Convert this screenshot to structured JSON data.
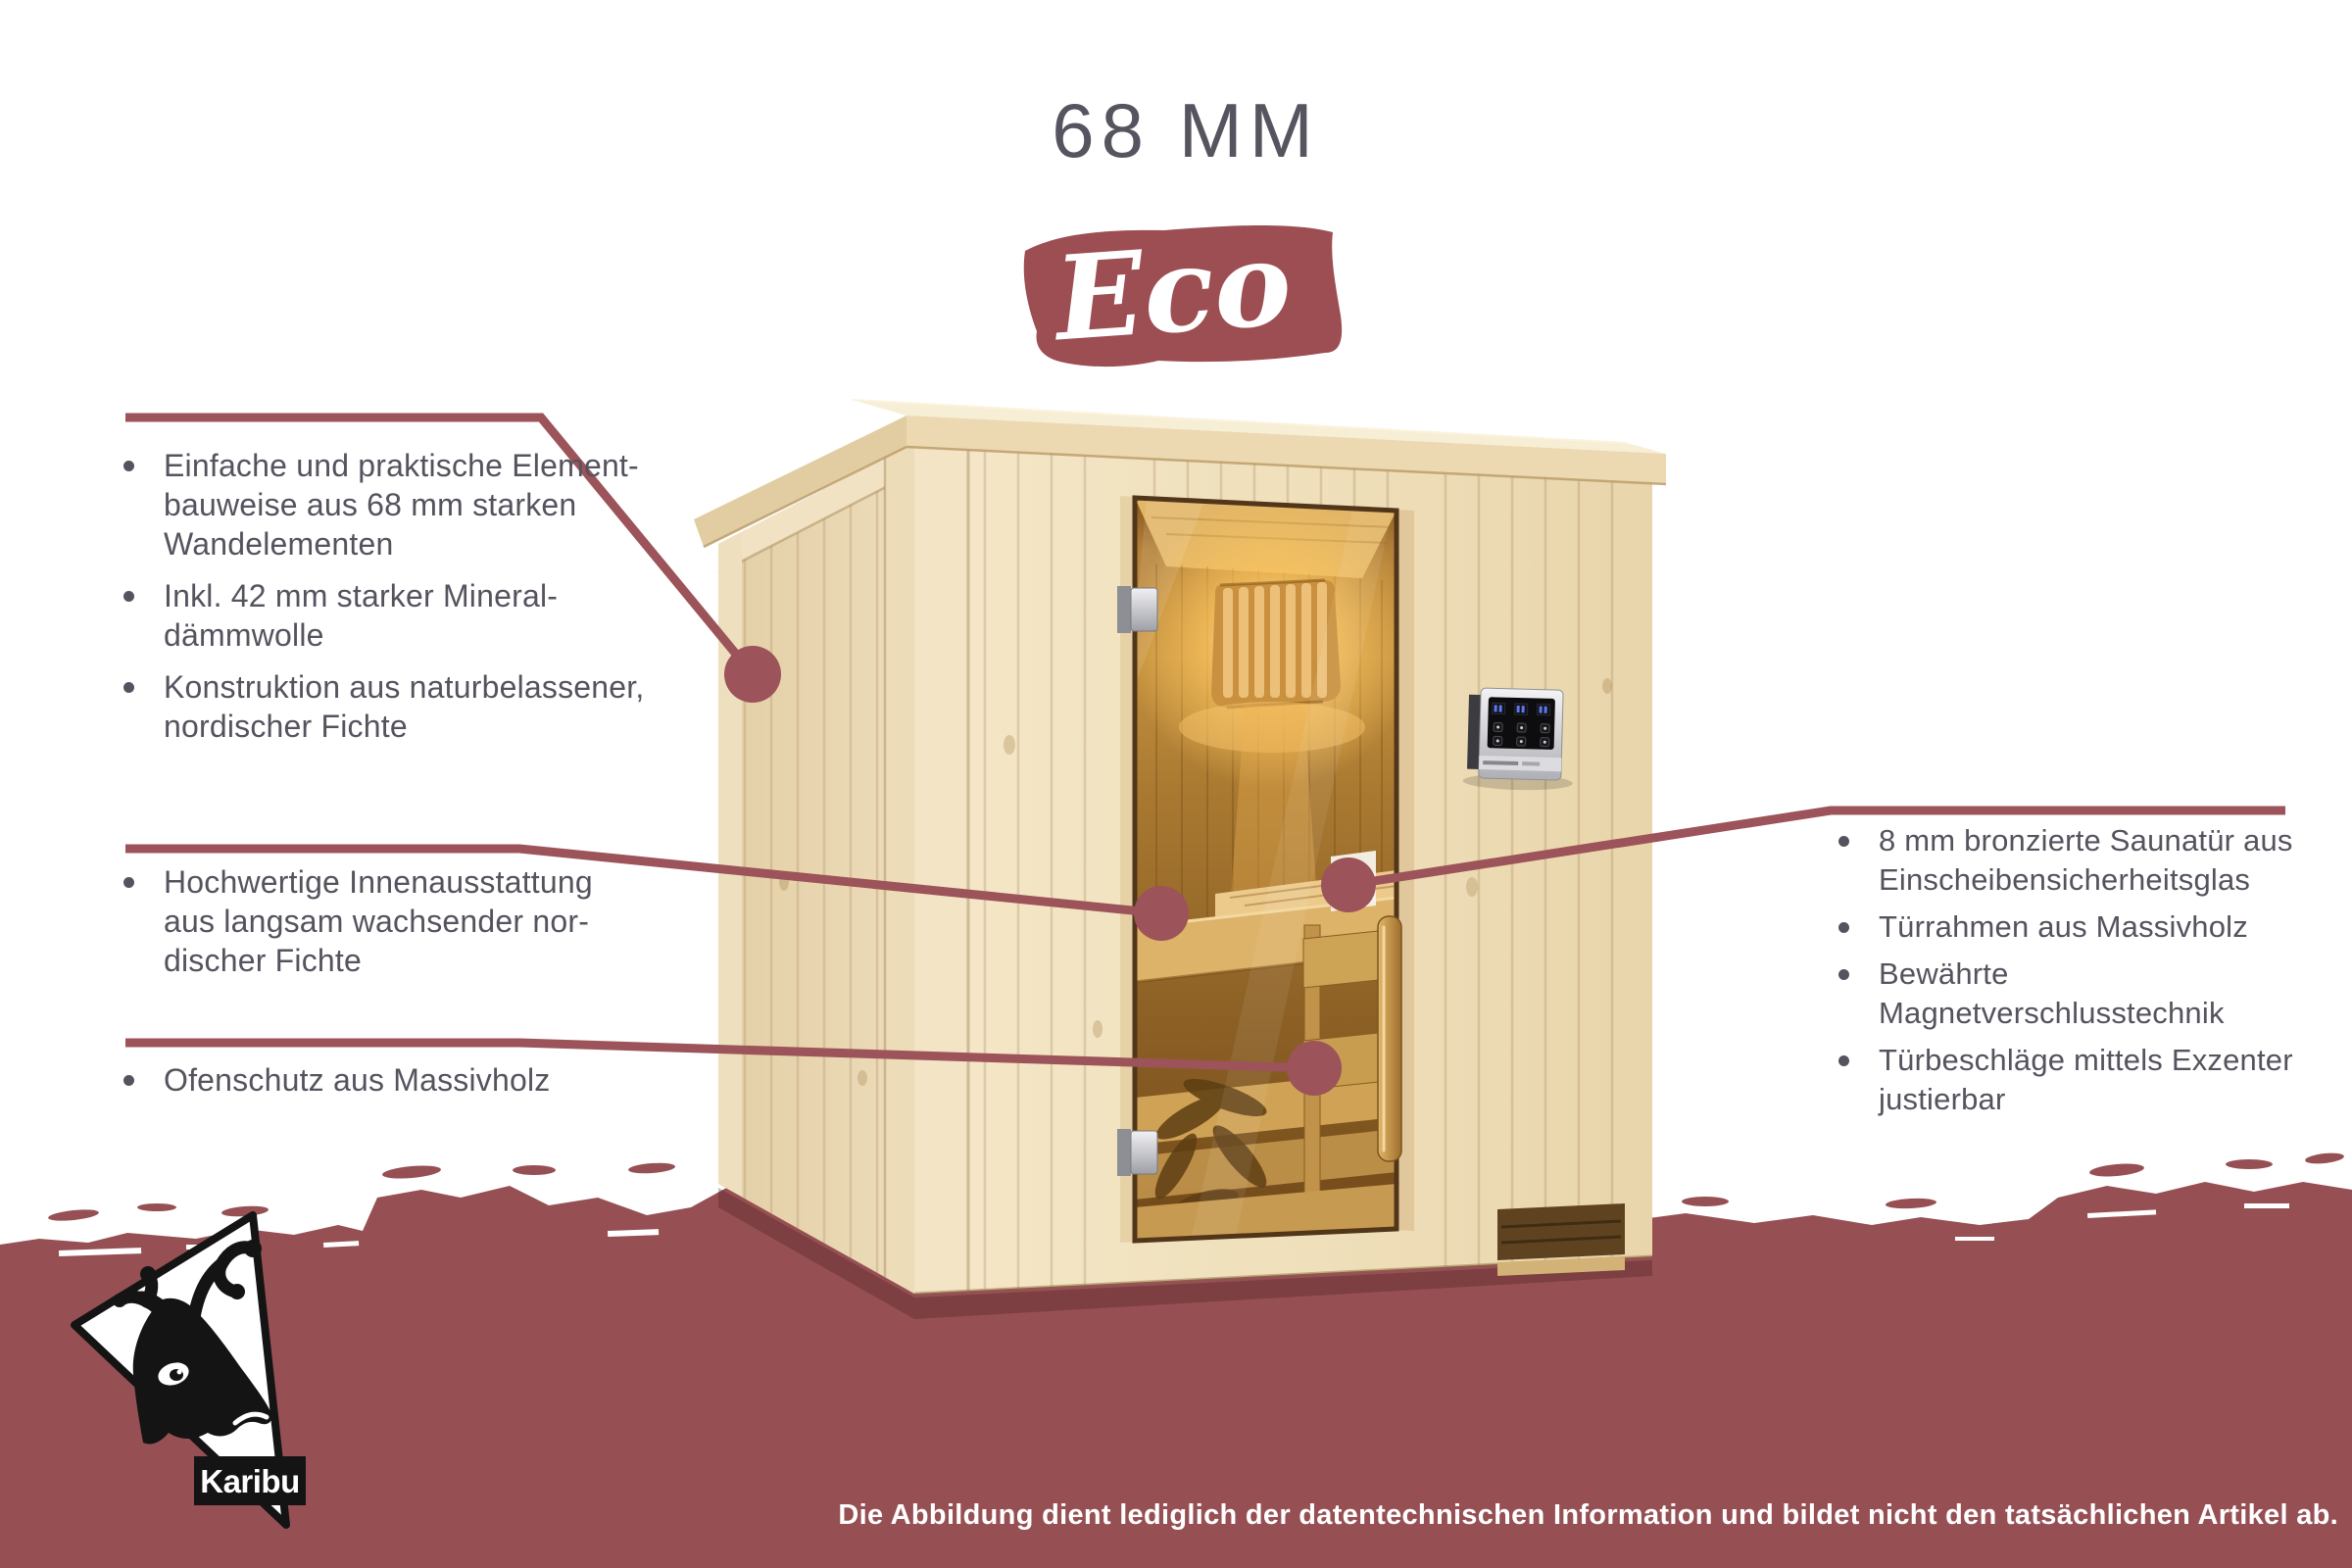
{
  "header": {
    "title": "68 MM",
    "badge": "Eco"
  },
  "features": {
    "left_top": [
      [
        "Einfache und praktische Element-",
        "bauweise aus 68 mm starken",
        "Wandelementen"
      ],
      [
        "Inkl. 42 mm starker Mineral-",
        "dämmwolle"
      ],
      [
        "Konstruktion aus naturbelassener,",
        "nordischer Fichte"
      ]
    ],
    "left_mid": [
      [
        "Hochwertige Innenausstattung",
        "aus langsam wachsender nor-",
        "discher Fichte"
      ]
    ],
    "left_bottom": [
      [
        "Ofenschutz aus Massivholz"
      ]
    ],
    "right": [
      [
        "8 mm bronzierte Saunatür aus",
        "Einscheibensicherheitsglas"
      ],
      [
        "Türrahmen aus Massivholz"
      ],
      [
        "Bewährte Magnetverschlusstechnik"
      ],
      [
        "Türbeschläge mittels Exzenter",
        "justierbar"
      ]
    ]
  },
  "logo": {
    "brand": "Karibu"
  },
  "footer": {
    "disclaimer": "Die Abbildung dient lediglich der datentechnischen Information und bildet nicht den tatsächlichen Artikel ab."
  },
  "icons": {
    "bullet": "round-dot",
    "callout": "line-with-dot",
    "reindeer": "karibu-deer-head"
  },
  "colors": {
    "band": "#965054",
    "badge": "#9C4E53",
    "callout_line": "#9C5359",
    "body_text": "#55535E",
    "wood_front": "#F0E0BC",
    "door_glass": "#B5823A"
  }
}
